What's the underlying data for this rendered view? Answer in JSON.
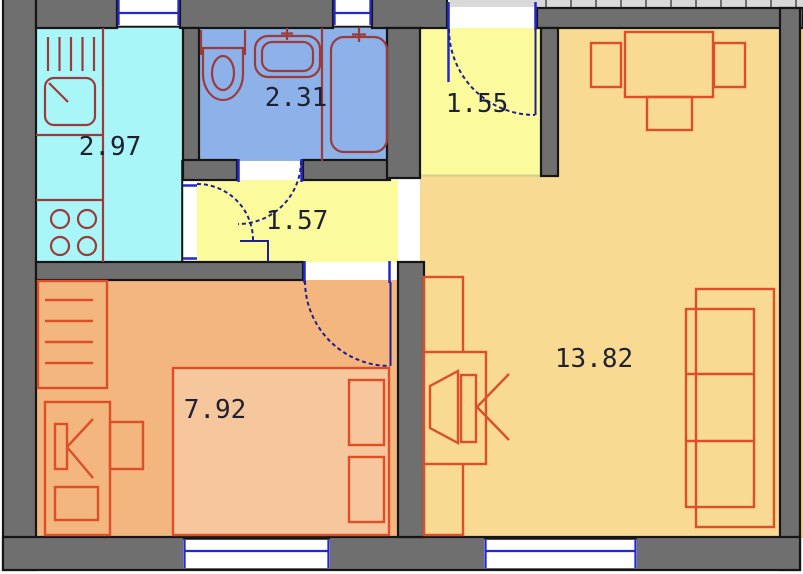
{
  "palette": {
    "wall": "#6f6f6f",
    "wall_outline": "#151515",
    "outside_strip": "#d9d9d9",
    "strip_tick": "#6f6f6f",
    "window_blue": "#2328cf",
    "door_navy": "#1f1f8e",
    "fixture_red": "#9c3b3b",
    "furniture_red": "#dd4f28",
    "bed_fill": "#f6c69c",
    "label_text": "#1e2230",
    "open_boundary": "#d2d28a",
    "neighbor_floor": "#f2d28b"
  },
  "rooms": [
    {
      "name": "kitchen",
      "area_label": "2.97",
      "floor_color": "#a9f6f8"
    },
    {
      "name": "bathroom",
      "area_label": "2.31",
      "floor_color": "#8db2e9"
    },
    {
      "name": "inner-hallway",
      "area_label": "1.57",
      "floor_color": "#fbfb9e"
    },
    {
      "name": "entry-hallway",
      "area_label": "1.55",
      "floor_color": "#fbfb9e"
    },
    {
      "name": "bedroom",
      "area_label": "7.92",
      "floor_color": "#f3b67f"
    },
    {
      "name": "living-room",
      "area_label": "13.82",
      "floor_color": "#f8da93"
    }
  ],
  "fixtures": {
    "kitchen": [
      "radiator",
      "kitchen-sink",
      "counter",
      "stove"
    ],
    "bathroom": [
      "toilet",
      "washbasin",
      "bathtub"
    ],
    "bedroom": [
      "wardrobe",
      "desk",
      "desk-chair",
      "bed"
    ],
    "living_room": [
      "dining-table",
      "dining-chairs",
      "tv",
      "wall-shelf",
      "sofa"
    ]
  }
}
